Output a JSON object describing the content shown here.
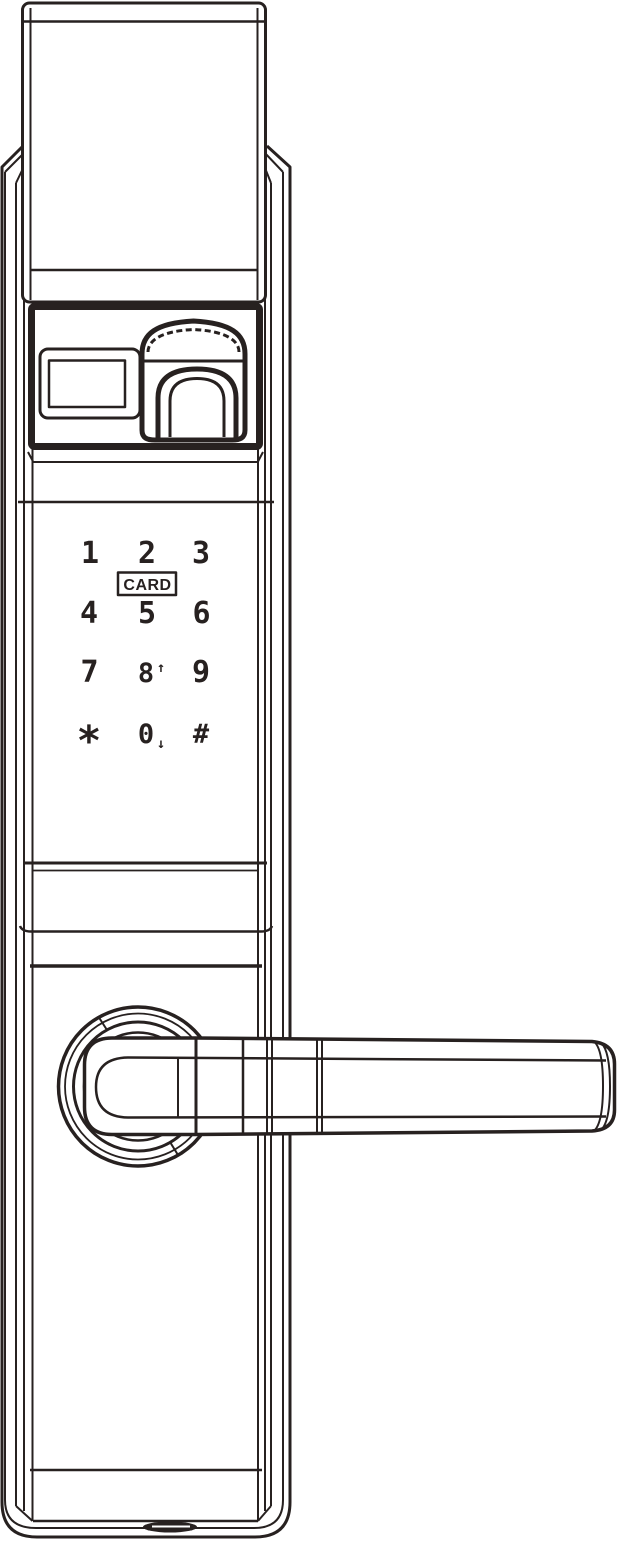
{
  "device_label": "smart-door-lock-line-drawing",
  "colors": {
    "line": "#272120",
    "background": "#ffffff"
  },
  "keypad": {
    "card_label": "CARD",
    "keys": [
      {
        "id": "key-1",
        "label": "1"
      },
      {
        "id": "key-2",
        "label": "2"
      },
      {
        "id": "key-3",
        "label": "3"
      },
      {
        "id": "key-4",
        "label": "4"
      },
      {
        "id": "key-5",
        "label": "5"
      },
      {
        "id": "key-6",
        "label": "6"
      },
      {
        "id": "key-7",
        "label": "7"
      },
      {
        "id": "key-8",
        "label": "8",
        "arrow": "↑"
      },
      {
        "id": "key-9",
        "label": "9"
      },
      {
        "id": "key-star",
        "label": "*"
      },
      {
        "id": "key-0",
        "label": "0",
        "arrow": "↓"
      },
      {
        "id": "key-hash",
        "label": "#"
      }
    ]
  }
}
